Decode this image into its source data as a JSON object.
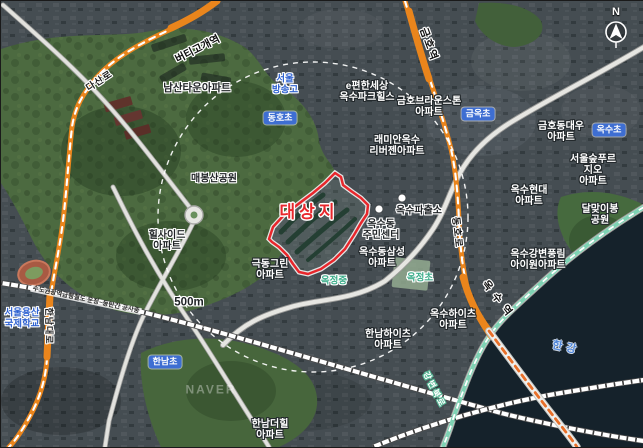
{
  "map": {
    "site_label": "대상지",
    "scale_label": "500m",
    "compass_label": "N",
    "watermark": "NAVER",
    "colors": {
      "site_red": "#e8272c",
      "road_orange": "#ea851c",
      "rail_mint": "#7fd3b4",
      "school_blue": "#3e6ed2",
      "school_mint_text": "#3fae8c",
      "school_blue_text": "#2f62d0"
    },
    "stations": [
      "버티고개역",
      "금호역",
      "옥수역"
    ],
    "roads": [
      "다산로",
      "동호로",
      "한남대로",
      "강변북로"
    ],
    "labels": [
      {
        "name": "label-namsan-town-apt",
        "text": "남산타운아파트",
        "x": 196,
        "y": 88,
        "cls": "lbl-dark",
        "fs": 10.5
      },
      {
        "name": "label-maebongsan-park",
        "text": "매봉산공원",
        "x": 213,
        "y": 178,
        "cls": "lbl-dark",
        "fs": 10
      },
      {
        "name": "label-seoul-broadcasting-hs",
        "text": "서울\n방송고",
        "x": 284,
        "y": 84,
        "cls": "lbl-blue",
        "fs": 9.5
      },
      {
        "name": "label-dongho-elementary",
        "text": "동호초",
        "x": 279,
        "y": 117,
        "cls": "lbl-pill"
      },
      {
        "name": "label-epyeonhansesang-oksu-parkhills",
        "text": "e편한세상\n옥수파크힐스",
        "x": 366,
        "y": 91,
        "cls": "lbl-light",
        "fs": 10
      },
      {
        "name": "label-geumho-brownstone-apt",
        "text": "금호브라운스톤\n아파트",
        "x": 428,
        "y": 106,
        "cls": "lbl-light",
        "fs": 10
      },
      {
        "name": "label-geumok-elementary",
        "text": "금옥초",
        "x": 477,
        "y": 113,
        "cls": "lbl-pill"
      },
      {
        "name": "label-raemian-oksu-rivergen-apt",
        "text": "래미안옥수\n리버젠아파트",
        "x": 396,
        "y": 145,
        "cls": "lbl-light",
        "fs": 10
      },
      {
        "name": "label-geumho-daewoo-apt",
        "text": "금호동대우\n아파트",
        "x": 560,
        "y": 131,
        "cls": "lbl-light",
        "fs": 10
      },
      {
        "name": "label-oksu-elementary",
        "text": "옥수초",
        "x": 608,
        "y": 129,
        "cls": "lbl-pill"
      },
      {
        "name": "label-seoulsup-prugio-apt",
        "text": "서울숲푸르지오\n아파트",
        "x": 592,
        "y": 170,
        "cls": "lbl-light",
        "fs": 10
      },
      {
        "name": "label-oksu-hyundai-apt",
        "text": "옥수현대\n아파트",
        "x": 528,
        "y": 195,
        "cls": "lbl-light",
        "fs": 10
      },
      {
        "name": "label-dalmajibong-park",
        "text": "달맞이봉공원",
        "x": 599,
        "y": 214,
        "cls": "lbl-light",
        "fs": 10
      },
      {
        "name": "label-oksu-gangbyeon-pungnim-iwon-apt",
        "text": "옥수강변풍림\n아이원아파트",
        "x": 537,
        "y": 259,
        "cls": "lbl-light",
        "fs": 10
      },
      {
        "name": "label-oksudong-samsung-apt",
        "text": "옥수동삼성\n아파트",
        "x": 381,
        "y": 257,
        "cls": "lbl-light",
        "fs": 10
      },
      {
        "name": "label-oksu-police-substation",
        "text": "옥수파출소",
        "x": 418,
        "y": 210,
        "cls": "lbl-dark",
        "fs": 10
      },
      {
        "name": "label-oksudong-community-center",
        "text": "옥수동\n주민센터",
        "x": 380,
        "y": 229,
        "cls": "lbl-dark",
        "fs": 10
      },
      {
        "name": "label-site-title",
        "text": "대상지",
        "x": 308,
        "y": 211,
        "cls": "lbl-site"
      },
      {
        "name": "label-geukdong-green-apt",
        "text": "극동그린\n아파트",
        "x": 269,
        "y": 269,
        "cls": "lbl-light",
        "fs": 10
      },
      {
        "name": "label-hillside-apt",
        "text": "힐사이드\n아파트",
        "x": 166,
        "y": 240,
        "cls": "lbl-dark",
        "fs": 10
      },
      {
        "name": "label-scale-500m",
        "text": "500m",
        "x": 188,
        "y": 302,
        "cls": "lbl-dark",
        "fs": 11.5
      },
      {
        "name": "label-seoul-yongsan-intl-school",
        "text": "서울용산\n국제학교",
        "x": 21,
        "y": 318,
        "cls": "lbl-blue",
        "fs": 9.5
      },
      {
        "name": "label-hannam-elementary",
        "text": "한남초",
        "x": 164,
        "y": 361,
        "cls": "lbl-pill"
      },
      {
        "name": "label-okjeong-middle",
        "text": "옥정중",
        "x": 333,
        "y": 281,
        "cls": "lbl-mint",
        "fs": 9.5
      },
      {
        "name": "label-okjeong-elementary",
        "text": "옥정초",
        "x": 419,
        "y": 278,
        "cls": "lbl-mint",
        "fs": 9.5
      },
      {
        "name": "label-oksu-heights-apt",
        "text": "옥수하이츠\n아파트",
        "x": 452,
        "y": 319,
        "cls": "lbl-light",
        "fs": 10
      },
      {
        "name": "label-hannam-heights-apt",
        "text": "한남하이츠\n아파트",
        "x": 387,
        "y": 339,
        "cls": "lbl-light",
        "fs": 10
      },
      {
        "name": "label-hannam-the-hill-apt",
        "text": "한남더힐\n아파트",
        "x": 269,
        "y": 429,
        "cls": "lbl-light",
        "fs": 10
      },
      {
        "name": "label-han-river",
        "text": "한강",
        "x": 565,
        "y": 347,
        "cls": "lbl-river",
        "rot": 12,
        "fs": 11,
        "ls": 4
      },
      {
        "name": "watermark-naver",
        "text": "NAVER",
        "x": 210,
        "y": 389,
        "cls": "lbl-ghost",
        "ls": 2
      },
      {
        "name": "label-beotigogae-station",
        "text": "버티고개역",
        "x": 197,
        "y": 49,
        "cls": "lbl-station",
        "rot": -27
      },
      {
        "name": "label-geumho-station",
        "text": "금호역",
        "x": 427,
        "y": 44,
        "cls": "lbl-station",
        "rot": 70,
        "ls": 2
      },
      {
        "name": "label-oksu-station",
        "text": "옥수역",
        "x": 497,
        "y": 300,
        "cls": "lbl-station",
        "rot": 52,
        "ls": 6
      },
      {
        "name": "label-dasan-ro",
        "text": "다산로",
        "x": 99,
        "y": 81,
        "cls": "lbl-road",
        "rot": -33,
        "ls": 1
      },
      {
        "name": "label-dongho-ro",
        "text": "동호로",
        "x": 455,
        "y": 232,
        "cls": "lbl-road",
        "rot": 84,
        "ls": 2
      },
      {
        "name": "label-hannam-daero",
        "text": "한남대로",
        "x": 48,
        "y": 325,
        "cls": "lbl-road",
        "rot": 90,
        "fs": 9,
        "ls": 1
      },
      {
        "name": "label-gangbyeon-expressway",
        "text": "강변북로",
        "x": 433,
        "y": 389,
        "cls": "lbl-mintroad",
        "rot": 63,
        "fs": 8.5,
        "ls": 2
      },
      {
        "name": "label-gtx-construction",
        "text": "수도권광역급행철도 운정~동탄간 공사중",
        "x": 85,
        "y": 299,
        "cls": "lbl-constr",
        "rot": 12
      },
      {
        "name": "compass-north-label",
        "text": "N",
        "x": 615,
        "y": 11,
        "cls": "lbl-compass"
      }
    ]
  }
}
